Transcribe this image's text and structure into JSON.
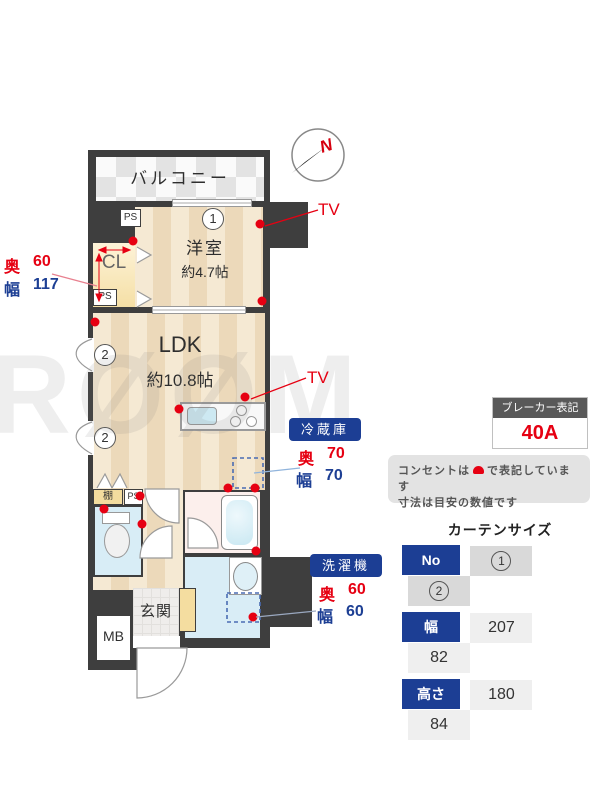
{
  "plan": {
    "rooms": {
      "balcony": "バルコニー",
      "bedroom": "洋室",
      "bedroom_size": "約4.7帖",
      "ldk": "LDK",
      "ldk_size": "約10.8帖",
      "closet": "CL",
      "entrance": "玄関",
      "meter_box": "MB",
      "shelf": "棚",
      "pipe_space": "PS"
    },
    "markers": {
      "n1": "1",
      "n2": "2"
    },
    "tv_label": "TV",
    "compass_n": "N"
  },
  "closet_dims": {
    "depth_label": "奥",
    "depth_value": "60",
    "width_label": "幅",
    "width_value": "117"
  },
  "fridge": {
    "title": "冷蔵庫",
    "depth_label": "奥",
    "depth_value": "70",
    "width_label": "幅",
    "width_value": "70"
  },
  "washer": {
    "title": "洗濯機",
    "depth_label": "奥",
    "depth_value": "60",
    "width_label": "幅",
    "width_value": "60"
  },
  "breaker": {
    "title": "ブレーカー表記",
    "value": "40A"
  },
  "notes": {
    "line1_pre": "コンセントは",
    "line1_post": "で表記しています",
    "line2": "寸法は目安の数値です"
  },
  "curtain": {
    "title": "カーテンサイズ",
    "col_header": "No",
    "row_width_label": "幅",
    "row_height_label": "高さ",
    "width_values": [
      "207",
      "82"
    ],
    "height_values": [
      "180",
      "84"
    ]
  },
  "watermark": "RØØM",
  "colors": {
    "accent_red": "#e60012",
    "accent_blue": "#1c3e94",
    "wall": "#3e3e3e"
  }
}
